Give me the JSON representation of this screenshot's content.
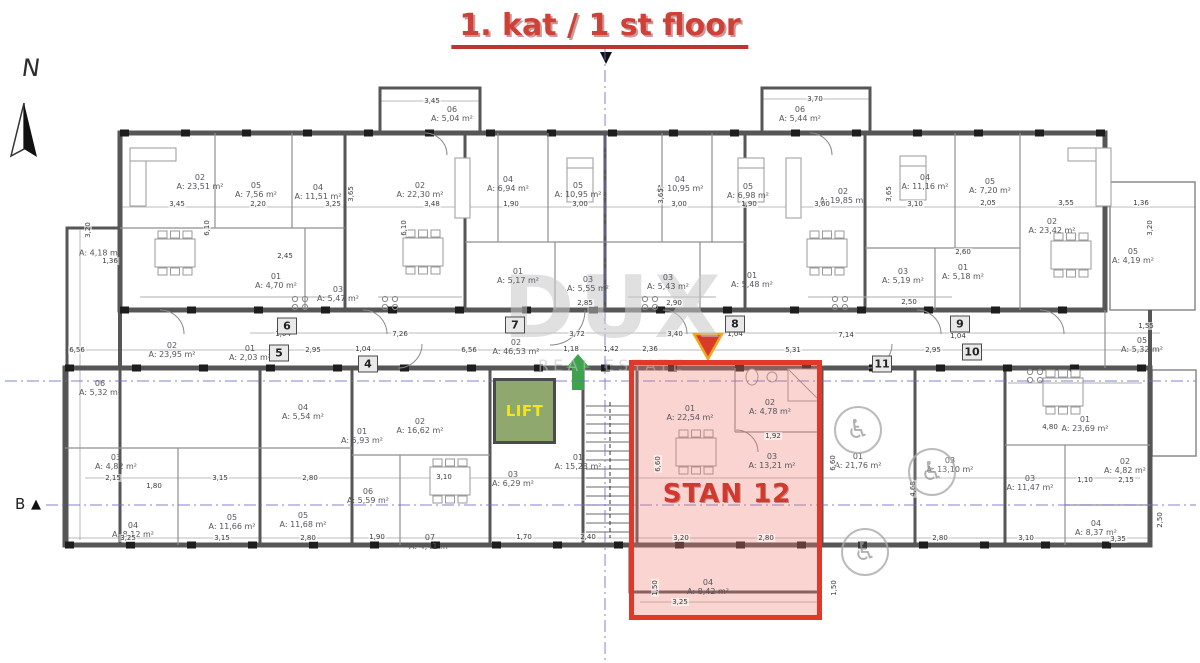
{
  "title": "1. kat / 1 st floor",
  "compass": {
    "label": "N"
  },
  "section_marker": {
    "label": "B",
    "arrow": "▲"
  },
  "watermark": {
    "line1": "DUX",
    "line2": "REAL ESTATE"
  },
  "lift": {
    "label": "LIFT"
  },
  "highlight": {
    "label": "STAN 12"
  },
  "icons": {
    "wheelchair": "♿"
  },
  "colors": {
    "title_red": "#cf4138",
    "highlight_border": "#e0392a",
    "highlight_fill": "rgba(238,123,112,0.33)",
    "lift_fill": "#8ea86d",
    "lift_text": "#f4e51d",
    "axis_blue": "#6a6ace",
    "arrow_green": "#3fa34d",
    "triangle_red": "#d93a2b",
    "triangle_border": "#f0a51e"
  },
  "plan": {
    "rooms": [
      {
        "n": "02",
        "a": "A: 23,51 m²",
        "x": 200,
        "y": 182
      },
      {
        "n": "05",
        "a": "A: 7,56 m²",
        "x": 256,
        "y": 190
      },
      {
        "n": "04",
        "a": "A: 11,51 m²",
        "x": 318,
        "y": 192
      },
      {
        "n": "",
        "a": "A: 4,18 m²",
        "x": 100,
        "y": 253
      },
      {
        "n": "06",
        "a": "A: 5,04 m²",
        "x": 452,
        "y": 114
      },
      {
        "n": "02",
        "a": "A: 22,30 m²",
        "x": 420,
        "y": 190
      },
      {
        "n": "04",
        "a": "A: 6,94 m²",
        "x": 508,
        "y": 184
      },
      {
        "n": "05",
        "a": "A: 10,95 m²",
        "x": 578,
        "y": 190
      },
      {
        "n": "01",
        "a": "A: 4,70 m²",
        "x": 276,
        "y": 281
      },
      {
        "n": "03",
        "a": "A: 5,47 m²",
        "x": 338,
        "y": 294
      },
      {
        "n": "01",
        "a": "A: 5,17 m²",
        "x": 518,
        "y": 276
      },
      {
        "n": "03",
        "a": "A: 5,55 m²",
        "x": 588,
        "y": 284
      },
      {
        "n": "06",
        "a": "A: 5,44 m²",
        "x": 800,
        "y": 114
      },
      {
        "n": "04",
        "a": "A: 10,95 m²",
        "x": 680,
        "y": 184
      },
      {
        "n": "05",
        "a": "A: 6,98 m²",
        "x": 748,
        "y": 191
      },
      {
        "n": "02",
        "a": "A: 19,85 m²",
        "x": 843,
        "y": 196
      },
      {
        "n": "03",
        "a": "A: 5,43 m²",
        "x": 668,
        "y": 282
      },
      {
        "n": "01",
        "a": "A: 5,48 m²",
        "x": 752,
        "y": 280
      },
      {
        "n": "04",
        "a": "A: 11,16 m²",
        "x": 925,
        "y": 182
      },
      {
        "n": "05",
        "a": "A: 7,20 m²",
        "x": 990,
        "y": 186
      },
      {
        "n": "02",
        "a": "A: 23,42 m²",
        "x": 1052,
        "y": 226
      },
      {
        "n": "03",
        "a": "A: 5,19 m²",
        "x": 903,
        "y": 276
      },
      {
        "n": "01",
        "a": "A: 5,18 m²",
        "x": 963,
        "y": 272
      },
      {
        "n": "05",
        "a": "A: 4,19 m²",
        "x": 1133,
        "y": 256
      },
      {
        "n": "02",
        "a": "A: 46,53 m²",
        "x": 516,
        "y": 347
      },
      {
        "n": "01",
        "a": "A: 2,03 m²",
        "x": 250,
        "y": 353
      },
      {
        "n": "02",
        "a": "A: 23,95 m²",
        "x": 172,
        "y": 350
      },
      {
        "n": "06",
        "a": "A: 5,32 m²",
        "x": 100,
        "y": 388
      },
      {
        "n": "03",
        "a": "A: 4,82 m²",
        "x": 116,
        "y": 462
      },
      {
        "n": "04",
        "a": "A: 8,12 m²",
        "x": 133,
        "y": 530
      },
      {
        "n": "05",
        "a": "A: 11,66 m²",
        "x": 232,
        "y": 522
      },
      {
        "n": "04",
        "a": "A: 5,54 m²",
        "x": 303,
        "y": 412
      },
      {
        "n": "01",
        "a": "A: 5,93 m²",
        "x": 362,
        "y": 436
      },
      {
        "n": "02",
        "a": "A: 16,62 m²",
        "x": 420,
        "y": 426
      },
      {
        "n": "06",
        "a": "A: 5,59 m²",
        "x": 368,
        "y": 496
      },
      {
        "n": "07",
        "a": "A: 4,41 m²",
        "x": 430,
        "y": 542
      },
      {
        "n": "05",
        "a": "A: 11,68 m²",
        "x": 303,
        "y": 520
      },
      {
        "n": "03",
        "a": "A: 6,29 m²",
        "x": 513,
        "y": 479
      },
      {
        "n": "01",
        "a": "A: 15,23 m²",
        "x": 578,
        "y": 462
      },
      {
        "n": "01",
        "a": "A: 22,54 m²",
        "x": 690,
        "y": 413
      },
      {
        "n": "02",
        "a": "A: 4,78 m²",
        "x": 770,
        "y": 407
      },
      {
        "n": "03",
        "a": "A: 13,21 m²",
        "x": 772,
        "y": 461
      },
      {
        "n": "04",
        "a": "A: 8,42 m²",
        "x": 708,
        "y": 587
      },
      {
        "n": "01",
        "a": "A: 21,76 m²",
        "x": 858,
        "y": 461
      },
      {
        "n": "03",
        "a": "A: 13,10 m²",
        "x": 950,
        "y": 465
      },
      {
        "n": "03",
        "a": "A: 11,47 m²",
        "x": 1030,
        "y": 483
      },
      {
        "n": "01",
        "a": "A: 23,69 m²",
        "x": 1085,
        "y": 424
      },
      {
        "n": "02",
        "a": "A: 4,82 m²",
        "x": 1125,
        "y": 466
      },
      {
        "n": "04",
        "a": "A: 8,37 m²",
        "x": 1096,
        "y": 528
      },
      {
        "n": "05",
        "a": "A: 5,32 m²",
        "x": 1142,
        "y": 345
      }
    ],
    "dims": [
      {
        "t": "3,45",
        "x": 177,
        "y": 204
      },
      {
        "t": "2,20",
        "x": 258,
        "y": 204
      },
      {
        "t": "3,25",
        "x": 333,
        "y": 204
      },
      {
        "t": "3,45",
        "x": 432,
        "y": 101
      },
      {
        "t": "3,48",
        "x": 432,
        "y": 204
      },
      {
        "t": "1,90",
        "x": 511,
        "y": 204
      },
      {
        "t": "3,00",
        "x": 580,
        "y": 204
      },
      {
        "t": "3,70",
        "x": 815,
        "y": 99
      },
      {
        "t": "3,00",
        "x": 679,
        "y": 204
      },
      {
        "t": "1,90",
        "x": 749,
        "y": 204
      },
      {
        "t": "3,60",
        "x": 822,
        "y": 204
      },
      {
        "t": "3,10",
        "x": 915,
        "y": 204
      },
      {
        "t": "2,05",
        "x": 988,
        "y": 203
      },
      {
        "t": "3,55",
        "x": 1066,
        "y": 203
      },
      {
        "t": "1,36",
        "x": 1141,
        "y": 203
      },
      {
        "t": "2,45",
        "x": 285,
        "y": 256
      },
      {
        "t": "2,60",
        "x": 963,
        "y": 252
      },
      {
        "t": "2,50",
        "x": 909,
        "y": 302
      },
      {
        "t": "2,85",
        "x": 585,
        "y": 303
      },
      {
        "t": "2,90",
        "x": 674,
        "y": 303
      },
      {
        "t": "6,10",
        "x": 207,
        "y": 228,
        "v": 1
      },
      {
        "t": "6,10",
        "x": 404,
        "y": 228,
        "v": 1
      },
      {
        "t": "3,65",
        "x": 351,
        "y": 194,
        "v": 1
      },
      {
        "t": "3,65",
        "x": 661,
        "y": 196,
        "v": 1
      },
      {
        "t": "3,65",
        "x": 889,
        "y": 194,
        "v": 1
      },
      {
        "t": "3,20",
        "x": 1150,
        "y": 228,
        "v": 1
      },
      {
        "t": "3,20",
        "x": 88,
        "y": 230,
        "v": 1
      },
      {
        "t": "1,36",
        "x": 110,
        "y": 261
      },
      {
        "t": "7,26",
        "x": 400,
        "y": 334
      },
      {
        "t": "1,04",
        "x": 283,
        "y": 334
      },
      {
        "t": "2,95",
        "x": 313,
        "y": 350
      },
      {
        "t": "1,04",
        "x": 363,
        "y": 349
      },
      {
        "t": "6,56",
        "x": 469,
        "y": 350
      },
      {
        "t": "3,72",
        "x": 577,
        "y": 334
      },
      {
        "t": "1,18",
        "x": 571,
        "y": 349
      },
      {
        "t": "1,42",
        "x": 611,
        "y": 349
      },
      {
        "t": "2,36",
        "x": 650,
        "y": 349
      },
      {
        "t": "3,40",
        "x": 675,
        "y": 334
      },
      {
        "t": "7,14",
        "x": 846,
        "y": 335
      },
      {
        "t": "1,04",
        "x": 735,
        "y": 334
      },
      {
        "t": "5,31",
        "x": 793,
        "y": 350
      },
      {
        "t": "1,04",
        "x": 958,
        "y": 336
      },
      {
        "t": "2,95",
        "x": 933,
        "y": 350
      },
      {
        "t": "1,55",
        "x": 1146,
        "y": 326
      },
      {
        "t": "6,56",
        "x": 77,
        "y": 350
      },
      {
        "t": "3,25",
        "x": 128,
        "y": 538
      },
      {
        "t": "1,80",
        "x": 154,
        "y": 486
      },
      {
        "t": "2,15",
        "x": 113,
        "y": 478
      },
      {
        "t": "3,15",
        "x": 220,
        "y": 478
      },
      {
        "t": "2,80",
        "x": 310,
        "y": 478
      },
      {
        "t": "3,15",
        "x": 222,
        "y": 538
      },
      {
        "t": "2,80",
        "x": 308,
        "y": 538
      },
      {
        "t": "1,90",
        "x": 377,
        "y": 537
      },
      {
        "t": "3,10",
        "x": 444,
        "y": 477
      },
      {
        "t": "1,70",
        "x": 524,
        "y": 537
      },
      {
        "t": "2,40",
        "x": 588,
        "y": 537
      },
      {
        "t": "1,92",
        "x": 773,
        "y": 436
      },
      {
        "t": "3,20",
        "x": 681,
        "y": 538
      },
      {
        "t": "2,80",
        "x": 766,
        "y": 538
      },
      {
        "t": "3,25",
        "x": 680,
        "y": 602
      },
      {
        "t": "1,50",
        "x": 655,
        "y": 588,
        "v": 1
      },
      {
        "t": "1,50",
        "x": 834,
        "y": 588,
        "v": 1
      },
      {
        "t": "6,60",
        "x": 658,
        "y": 464,
        "v": 1
      },
      {
        "t": "6,60",
        "x": 833,
        "y": 463,
        "v": 1
      },
      {
        "t": "4,80",
        "x": 1050,
        "y": 427
      },
      {
        "t": "1,10",
        "x": 1085,
        "y": 480
      },
      {
        "t": "2,15",
        "x": 1126,
        "y": 480
      },
      {
        "t": "2,80",
        "x": 940,
        "y": 538
      },
      {
        "t": "3,10",
        "x": 1026,
        "y": 538
      },
      {
        "t": "3,35",
        "x": 1118,
        "y": 539
      },
      {
        "t": "4,68",
        "x": 913,
        "y": 489,
        "v": 1
      },
      {
        "t": "2,50",
        "x": 1160,
        "y": 520,
        "v": 1
      }
    ],
    "markers": [
      {
        "n": "4",
        "x": 368,
        "y": 364
      },
      {
        "n": "5",
        "x": 279,
        "y": 353
      },
      {
        "n": "6",
        "x": 287,
        "y": 326
      },
      {
        "n": "7",
        "x": 515,
        "y": 325
      },
      {
        "n": "8",
        "x": 735,
        "y": 324
      },
      {
        "n": "9",
        "x": 960,
        "y": 324
      },
      {
        "n": "10",
        "x": 972,
        "y": 352
      },
      {
        "n": "11",
        "x": 882,
        "y": 364
      }
    ],
    "access": [
      {
        "x": 858,
        "y": 430
      },
      {
        "x": 932,
        "y": 472
      },
      {
        "x": 865,
        "y": 552
      }
    ]
  }
}
